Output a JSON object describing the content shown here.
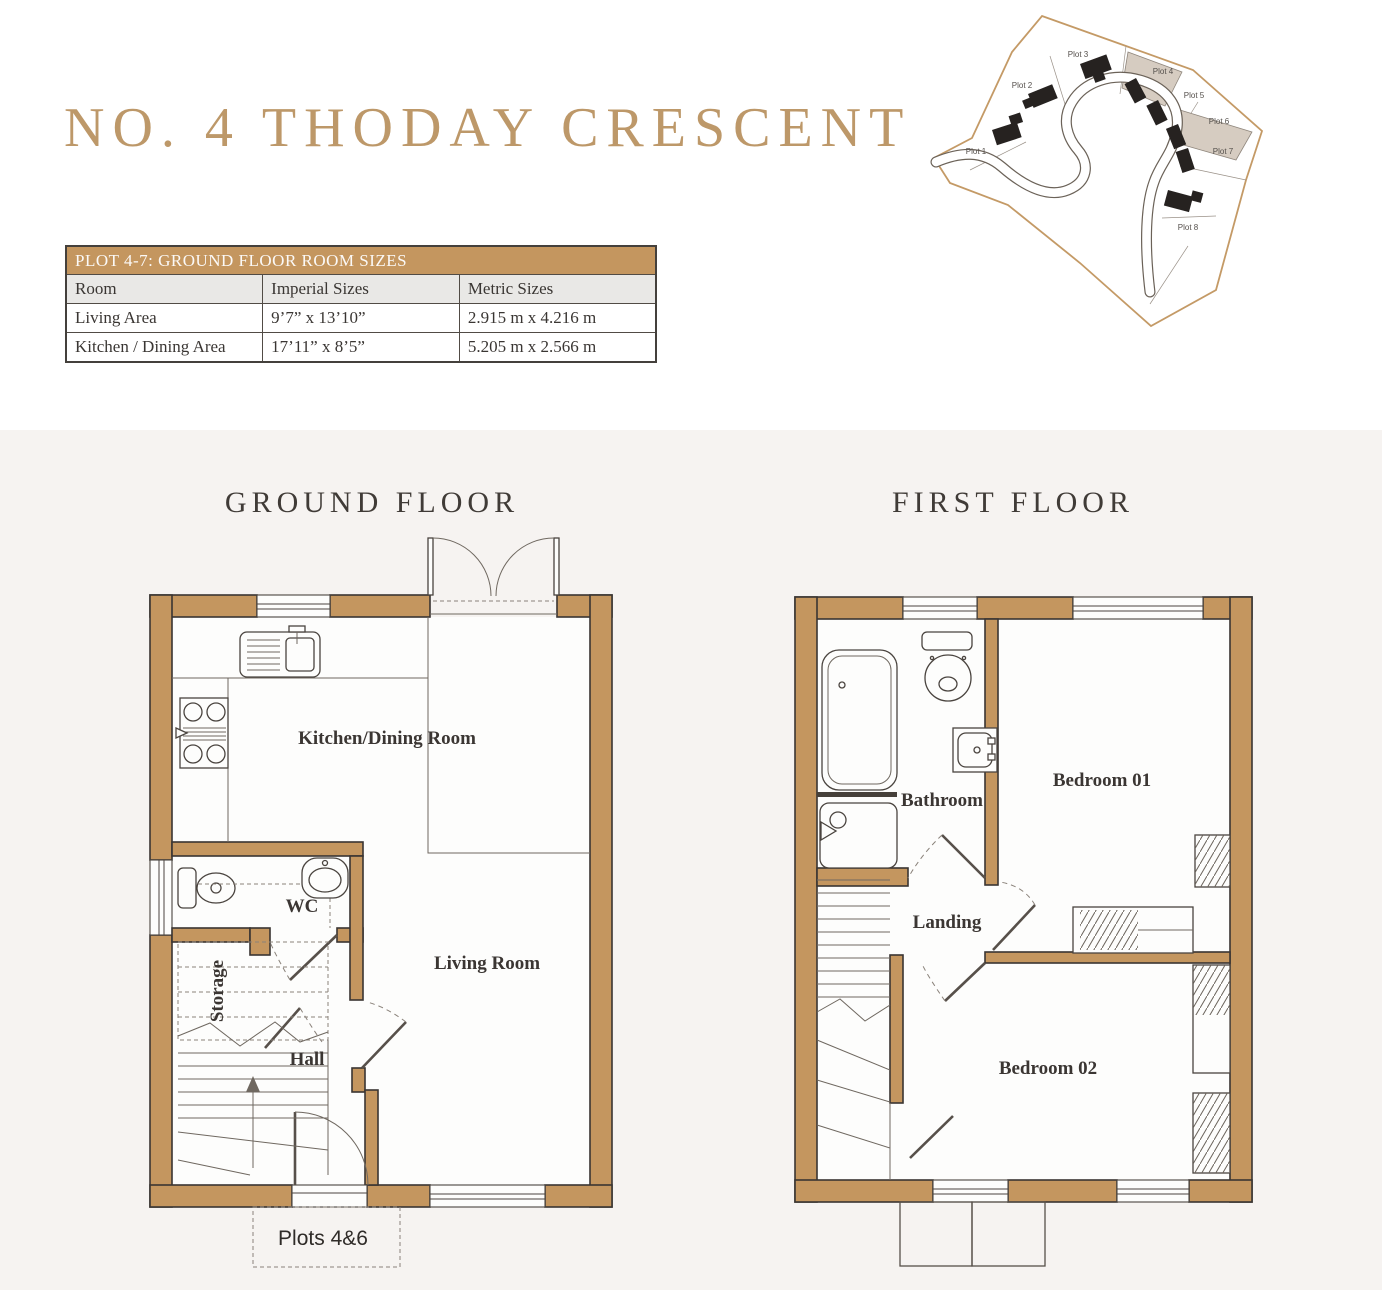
{
  "page": {
    "title": "NO. 4 THODAY CRESCENT"
  },
  "room_table": {
    "title": "PLOT 4-7: GROUND FLOOR ROOM SIZES",
    "columns": [
      "Room",
      "Imperial Sizes",
      "Metric Sizes"
    ],
    "rows": [
      {
        "room": "Living Area",
        "imperial": "9’7” x 13’10”",
        "metric": "2.915 m x 4.216 m"
      },
      {
        "room": "Kitchen / Dining Area",
        "imperial": "17’11” x 8’5”",
        "metric": "5.205 m x 2.566 m"
      }
    ]
  },
  "site_plan": {
    "plots": [
      {
        "label": "Plot 1",
        "highlighted": false
      },
      {
        "label": "Plot 2",
        "highlighted": false
      },
      {
        "label": "Plot 3",
        "highlighted": false
      },
      {
        "label": "Plot 4",
        "highlighted": true
      },
      {
        "label": "Plot 5",
        "highlighted": false
      },
      {
        "label": "Plot 6",
        "highlighted": true
      },
      {
        "label": "Plot 7",
        "highlighted": false
      },
      {
        "label": "Plot 8",
        "highlighted": false
      }
    ]
  },
  "ground_floor": {
    "title": "GROUND FLOOR",
    "rooms": {
      "kitchen": "Kitchen/Dining Room",
      "wc": "WC",
      "storage": "Storage",
      "hall": "Hall",
      "living": "Living Room"
    },
    "plot_note": "Plots 4&6"
  },
  "first_floor": {
    "title": "FIRST FLOOR",
    "rooms": {
      "bathroom": "Bathroom",
      "landing": "Landing",
      "bedroom1": "Bedroom 01",
      "bedroom2": "Bedroom 02"
    }
  },
  "colors": {
    "wall": "#C4965F",
    "title_accent": "#BD9869",
    "outline": "#3A3532",
    "panel_bg": "#F6F3F1",
    "plot_highlight": "#D6CCC1"
  }
}
